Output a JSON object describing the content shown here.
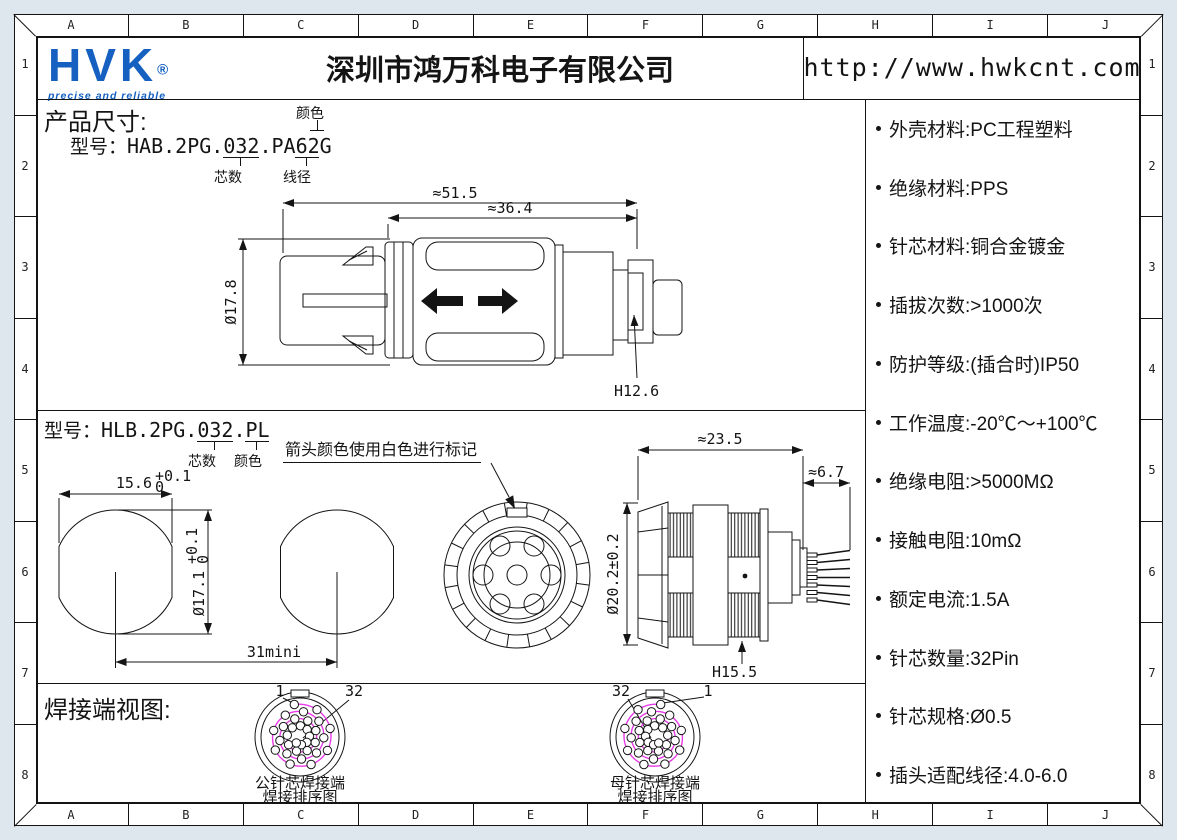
{
  "colors": {
    "blue": "#1560c0",
    "magenta": "#e83ae8",
    "line": "#141414",
    "sheet_bg": "#ffffff",
    "canvas_bg": "#dee6ee"
  },
  "grid": {
    "cols": [
      "A",
      "B",
      "C",
      "D",
      "E",
      "F",
      "G",
      "H",
      "I",
      "J"
    ],
    "rows": [
      "1",
      "2",
      "3",
      "4",
      "5",
      "6",
      "7",
      "8"
    ]
  },
  "header": {
    "logo_text": "HVK",
    "logo_reg": "®",
    "logo_tagline": "precise and reliable",
    "company": "深圳市鸿万科电子有限公司",
    "website": "http://www.hwkcnt.com"
  },
  "specs": [
    "外壳材料:PC工程塑料",
    "绝缘材料:PPS",
    "针芯材料:铜合金镀金",
    "插拔次数:>1000次",
    "防护等级:(插合时)IP50",
    "工作温度:-20℃～+100℃",
    "绝缘电阻:>5000MΩ",
    "接触电阻:10mΩ",
    "额定电流:1.5A",
    "针芯数量:32Pin",
    "针芯规格:Ø0.5",
    "插头适配线径:4.0-6.0"
  ],
  "product": {
    "title": "产品尺寸:",
    "model_label": "型号：",
    "model": "HAB.2PG.032.PA62G",
    "callout_color": "颜色",
    "callout_cores": "芯数",
    "callout_wire": "线径",
    "dims": {
      "overall": "≈51.5",
      "body": "≈36.4",
      "diameter": "Ø17.8",
      "height": "H12.6"
    }
  },
  "panel": {
    "model_label": "型号：",
    "model": "HLB.2PG.032.PL",
    "callout_cores": "芯数",
    "callout_color": "颜色",
    "note": "箭头颜色使用白色进行标记",
    "dims": {
      "flat_width": "15.6",
      "flat_tol_up": "+0.1",
      "flat_tol_dn": "0",
      "diameter": "Ø17.1",
      "dia_tol_up": "+0.1",
      "dia_tol_dn": "0",
      "spacing": "31mini",
      "length": "≈23.5",
      "rear_length": "≈6.7",
      "mount_dia": "Ø20.2±0.2",
      "height": "H15.5"
    }
  },
  "weld": {
    "title": "焊接端视图:",
    "pin_count": 32,
    "male": {
      "first_pin": "1",
      "last_pin": "32",
      "caption_line1": "公针芯焊接端",
      "caption_line2": "焊接排序图"
    },
    "female": {
      "first_pin": "32",
      "last_pin": "1",
      "caption_line1": "母针芯焊接端",
      "caption_line2": "焊接排序图"
    }
  }
}
